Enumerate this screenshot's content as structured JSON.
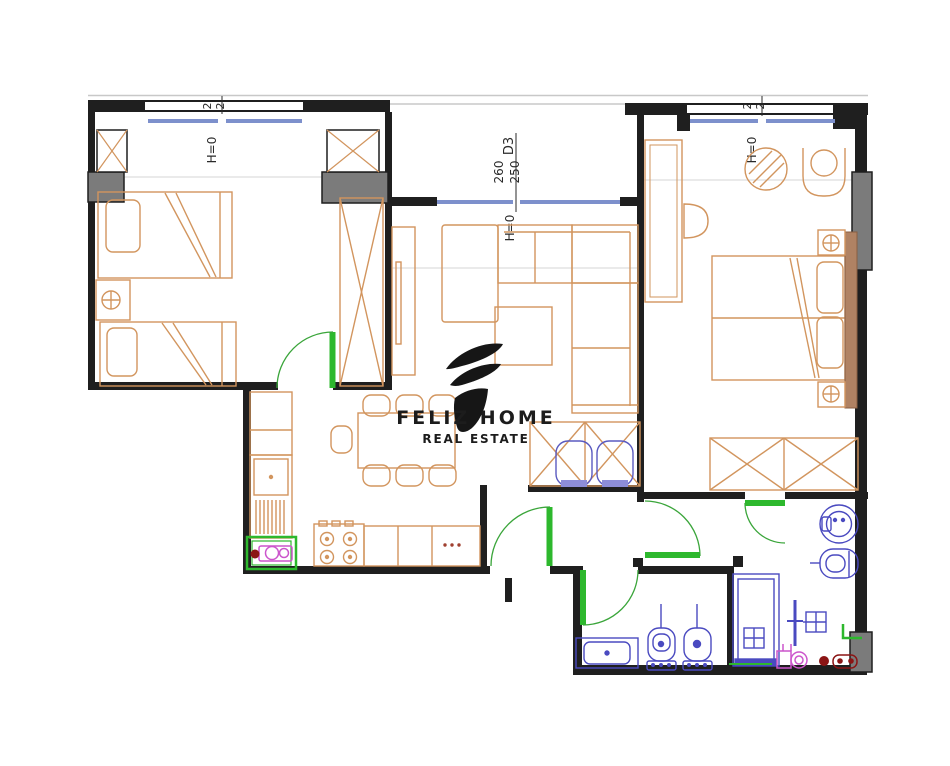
{
  "logo": {
    "title": "FELIZ HOME",
    "subtitle": "REAL ESTATE"
  },
  "windows": {
    "left": {
      "pane_a": "2",
      "pane_b": "2",
      "sill": "H=0"
    },
    "center": {
      "door_code": "D3",
      "dim_a": "260",
      "dim_b": "250",
      "sill": "H=0"
    },
    "right": {
      "pane_a": "2",
      "pane_b": "2",
      "sill": "H=0"
    }
  },
  "colors": {
    "wall": "#1f1f1f",
    "column": "#7b7b7b",
    "furniture": "#d2955e",
    "window_sill": "#7d90cc",
    "door": "#2db82d",
    "plumbing": "#4a4ac0",
    "fixture_magenta": "#cc55cc",
    "fixture_red": "#8b1515",
    "headboard": "#b08263",
    "logo": "#1c1c1c",
    "guide_line": "#c8c8c8"
  }
}
